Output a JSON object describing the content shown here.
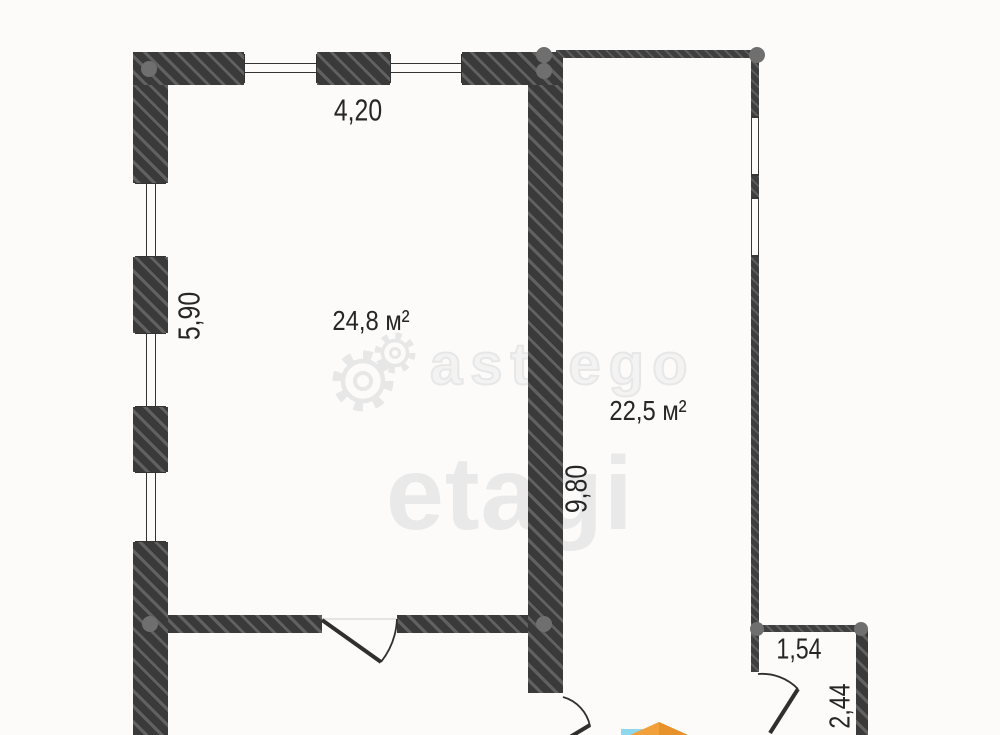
{
  "title": "Floor plan",
  "rooms": {
    "room1": {
      "area": "24,8 м²"
    },
    "room2": {
      "area": "22,5 м²"
    }
  },
  "dimensions": {
    "top_width": "4,20",
    "left_height": "5,90",
    "right_height": "9,80",
    "small_room_width": "1,54",
    "small_room_height": "2,44"
  },
  "watermark": {
    "brand_outline": "astrego",
    "brand_solid": "etagi",
    "gear_icon": "gear-icon",
    "logo_mark": "compass-logo-mark"
  },
  "colors": {
    "wall": "#3a3a3a",
    "hatch_line": "#5f5f5f",
    "plan_line": "#2f2f2f",
    "label_text": "#262626",
    "watermark_gray": "#e8e8e8",
    "corner_dot": "#6f6f6f",
    "logo_orange": "#f2a13a",
    "logo_teal": "#8ed7ef",
    "background": "#fcfbfa"
  }
}
